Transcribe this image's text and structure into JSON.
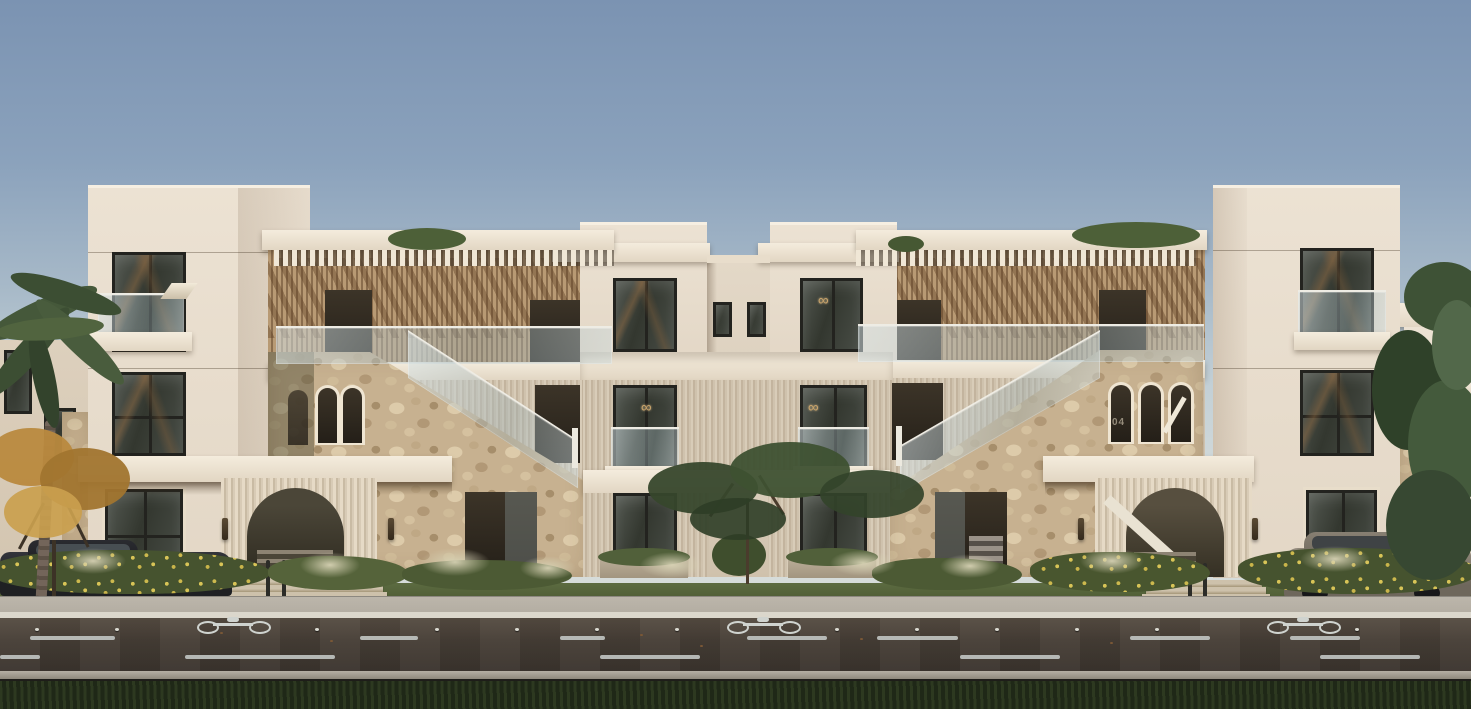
{
  "scene": {
    "description": "Architectural exterior rendering of a symmetric three-storey beige residential building with stone-clad stair walls, arched entrance portals, rooftop pergolas, glass balustrades, landscaping, parked cars and a street with a marked bike lane in the foreground."
  },
  "building": {
    "unit_number": "04"
  },
  "decor": {
    "chandelier_glyph": "∞"
  },
  "palette": {
    "sky-top": "#7b93b2",
    "sky-horizon": "#d6dcda",
    "wall-light": "#ece2d3",
    "wall-shade": "#d5c7b3",
    "stone-base": "#c7b190",
    "flute-base": "#cdc0ab",
    "wood-base": "#a98c68",
    "window-frame": "#23231f",
    "glass-tint": "#aebfc3",
    "road-dark": "#3a332d",
    "road-light": "#564c42",
    "sidewalk": "#b3ada2",
    "curb": "#dbd7cc",
    "lawn-strip": "#5c6b41",
    "foreground-grass": "#232d1a",
    "hedge-green": "#46532f",
    "flower-yellow": "#d8c457",
    "palm-green": "#45583a",
    "autumn-gold": "#b9893e",
    "tree-green": "#3e5236",
    "chandelier-gold": "#c9a36a",
    "marking-white": "#c9cecb"
  }
}
